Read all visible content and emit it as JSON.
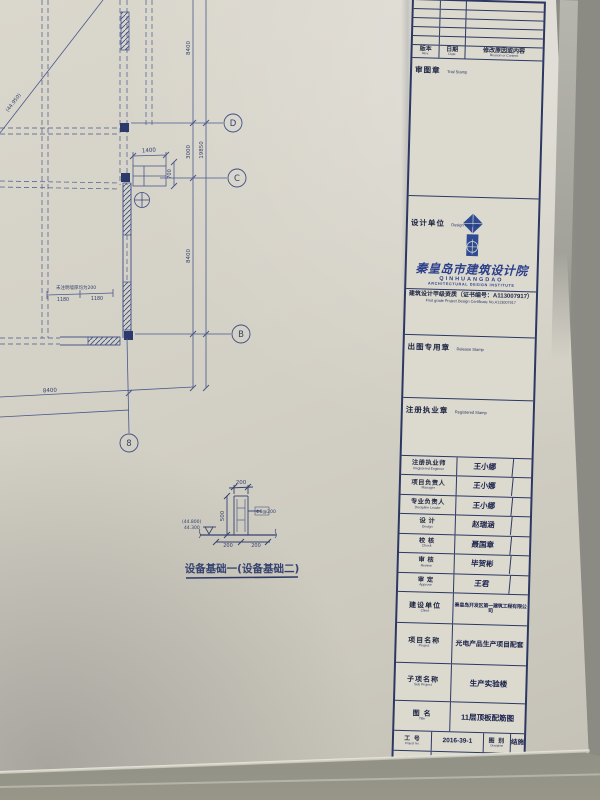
{
  "plan": {
    "grid": {
      "d": "D",
      "c": "C",
      "b": "B",
      "n8": "8"
    },
    "dims": {
      "top_8400": "8400",
      "v_3000": "3000",
      "v_19850": "19850",
      "mid_8400": "8400",
      "h_1400": "1400",
      "v_700": "700",
      "bottom_8400": "8400",
      "d_1180_a": "1180",
      "d_1180_b": "1180"
    },
    "slope_elevation": "(44.950)",
    "wall_note": "未注明墙厚均为200"
  },
  "detail": {
    "title": "设备基础一(设备基础二)",
    "dims": {
      "top": "200",
      "height": "500",
      "rebar": "Φ8@200",
      "elev_paren": "(44.800)",
      "elev": "44.300",
      "bottom_left": "200",
      "bottom_right": "200"
    }
  },
  "titleblock": {
    "revision_header": {
      "rev_cn": "版本",
      "rev_en": "Rev.",
      "date_cn": "日期",
      "date_en": "Date",
      "reason_cn": "修改原因或内容",
      "reason_en": "Reason or Content"
    },
    "trial_stamp": {
      "cn": "审图章",
      "en": "Trial Stamp"
    },
    "design_unit": {
      "label_cn": "设计单位",
      "label_en": "Design Institute",
      "institute_cn": "秦皇岛市建筑设计院",
      "institute_en": "QINHUANGDAO",
      "institute_en2": "ARCHITECTURAL DESIGN INSTITUTE",
      "certificate_cn": "建筑设计甲级资质（证书编号：A113007917）",
      "certificate_en": "First grade Project Design Certificate No.A113007917"
    },
    "release_stamp": {
      "cn": "出图专用章",
      "en": "Release Stamp"
    },
    "registered_stamp": {
      "cn": "注册执业章",
      "en": "Registered Stamp"
    },
    "personnel": [
      {
        "cn": "注册执业师",
        "en": "Registered Engineer",
        "name": "王小娜"
      },
      {
        "cn": "项目负责人",
        "en": "Manager",
        "name": "王小娜"
      },
      {
        "cn": "专业负责人",
        "en": "Discipline Leader",
        "name": "王小娜"
      },
      {
        "cn": "设 计",
        "en": "Design",
        "name": "赵瑞涵"
      },
      {
        "cn": "校 核",
        "en": "Check",
        "name": "聂国章"
      },
      {
        "cn": "审 核",
        "en": "Review",
        "name": "毕贺彬"
      },
      {
        "cn": "审 定",
        "en": "Approve",
        "name": "王君"
      }
    ],
    "project_rows": [
      {
        "cn": "建设单位",
        "en": "Client",
        "value": "秦皇岛开发区第一建筑工程有限公司"
      },
      {
        "cn": "项目名称",
        "en": "Project",
        "value": "光电产品生产项目配套"
      },
      {
        "cn": "子项名称",
        "en": "Sub Project",
        "value": "生产实验楼"
      },
      {
        "cn": "图 名",
        "en": "Title",
        "value": "11层顶板配筋图"
      }
    ],
    "meta": {
      "job_cn": "工 号",
      "job_en": "Project No.",
      "job_value": "2016-39-1",
      "discipline_cn": "图 别",
      "discipline_en": "Discipline",
      "discipline_value": "结施",
      "date_cn": "日 期",
      "date_en": "Date",
      "date_value": "2017-10-30",
      "sheet_cn": "图 号",
      "sheet_en": "Drawing No.",
      "sheet_value": "30"
    }
  },
  "colors": {
    "ink": "#2c3863",
    "logo_blue": "#2d4a93",
    "paper": "#d3d0c5"
  }
}
